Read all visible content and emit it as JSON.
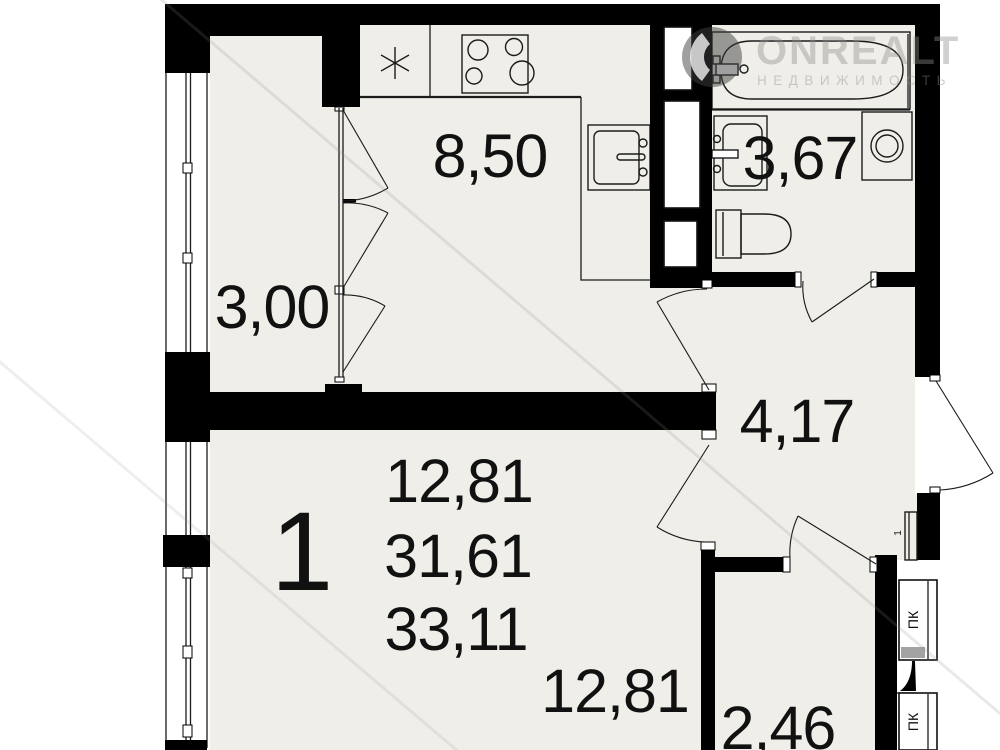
{
  "watermark": {
    "brand": "ONREALT",
    "subtitle": "НЕДВИЖИМОСТЬ"
  },
  "apartment": {
    "number": "1",
    "living_area": "12,81",
    "area_without_balcony": "31,61",
    "total_area": "33,11"
  },
  "rooms": {
    "kitchen": {
      "area": "8,50"
    },
    "bathroom": {
      "area": "3,67"
    },
    "balcony": {
      "area": "3,00"
    },
    "hallway": {
      "area": "4,17"
    },
    "living_room": {
      "area": "12,81"
    },
    "corridor": {
      "area": "2,46"
    }
  },
  "annotations": {
    "fire_cabinet_top": "ПК",
    "fire_cabinet_bottom": "ПК",
    "side_mark": "1"
  },
  "colors": {
    "walls": "#000000",
    "floor": "#efeee9",
    "lines": "#1b1b1b",
    "watermark": "#bfbfbf"
  }
}
